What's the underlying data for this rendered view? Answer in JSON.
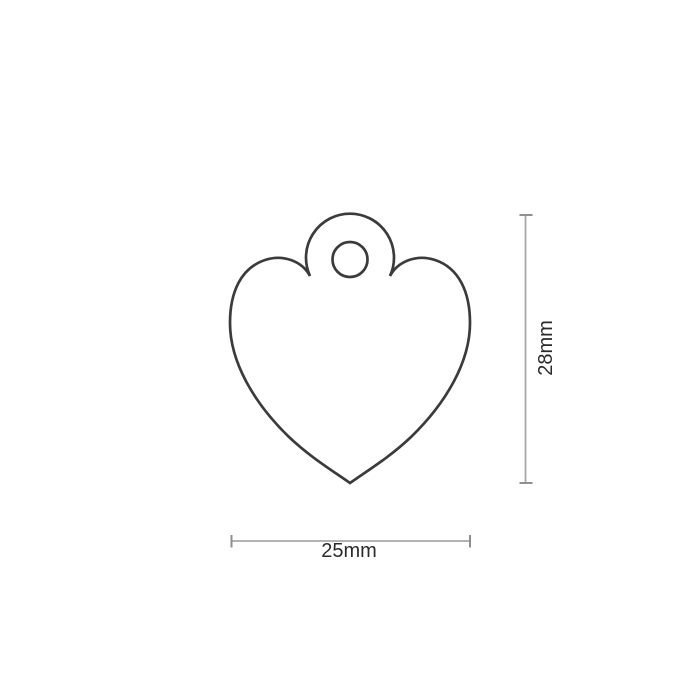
{
  "page": {
    "background": "#ffffff"
  },
  "diagram": {
    "name": "heart-pet-tag-dimension-diagram",
    "shape": "heart tag outline with hanging loop and hole",
    "width": {
      "value": 25,
      "unit": "mm",
      "label": "25mm"
    },
    "height": {
      "value": 28,
      "unit": "mm",
      "label": "28mm"
    },
    "colors": {
      "outline": "#3b3b3b",
      "dimension_line": "#a8a8a8",
      "dimension_tick": "#8f8f8f",
      "label_text": "#2b2b2b",
      "background": "#ffffff"
    }
  }
}
